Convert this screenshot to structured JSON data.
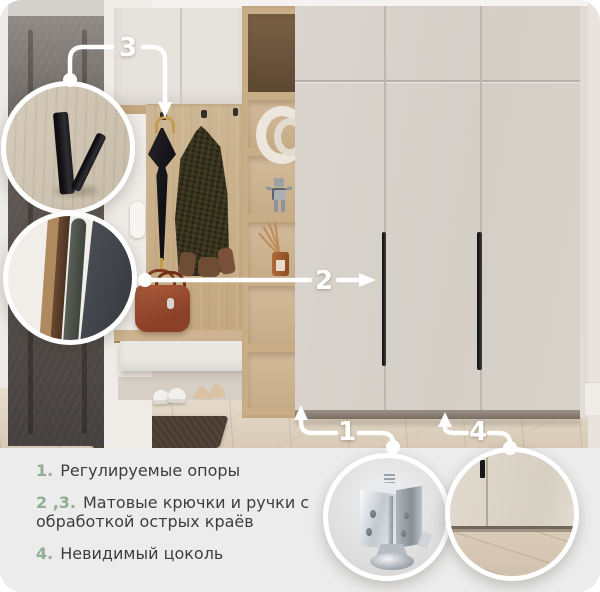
{
  "callouts": {
    "c1": "1",
    "c2": "2",
    "c3": "3",
    "c4": "4"
  },
  "legend": [
    {
      "num": "1.",
      "text": "Регулируемые опоры"
    },
    {
      "num": "2 ,3.",
      "text": "Матовые крючки и ручки с обработкой острых краёв"
    },
    {
      "num": "4.",
      "text": "Невидимый цоколь"
    }
  ],
  "colors": {
    "accent_green": "#8fae93",
    "callout_white": "#ffffff",
    "legend_background": "#ececec",
    "legend_text": "#3e3e3e"
  }
}
